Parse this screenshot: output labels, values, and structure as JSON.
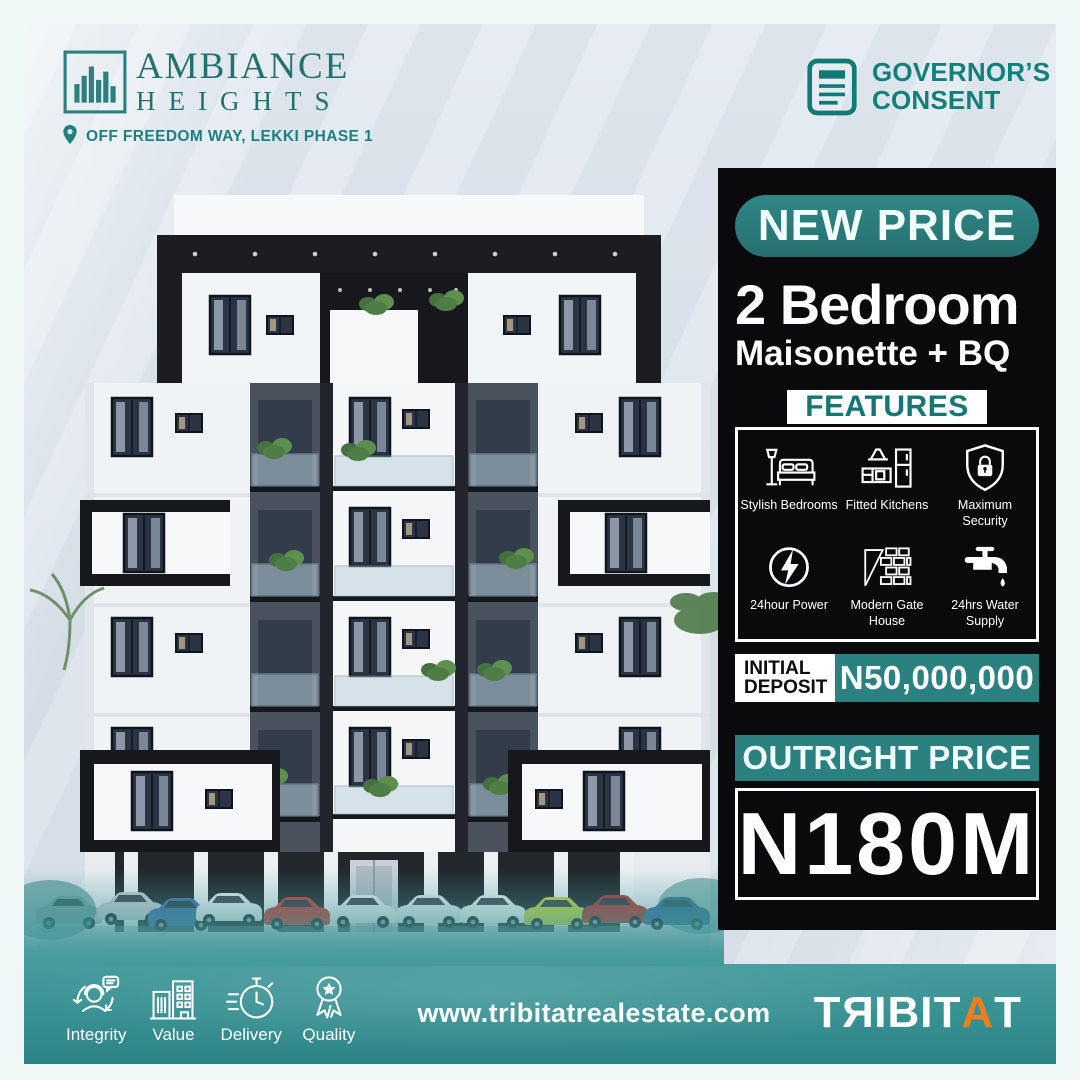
{
  "brand": {
    "name_line1": "AMBIANCE",
    "name_line2": "HEIGHTS",
    "location": "OFF FREEDOM WAY, LEKKI PHASE 1"
  },
  "badge": {
    "line1": "GOVERNOR’S",
    "line2": "CONSENT"
  },
  "offer": {
    "tag": "NEW PRICE",
    "unit_line1": "2 Bedroom",
    "unit_line2": "Maisonette + BQ",
    "features_title": "FEATURES",
    "features": [
      {
        "icon": "bed-icon",
        "label": "Stylish Bedrooms"
      },
      {
        "icon": "kitchen-icon",
        "label": "Fitted Kitchens"
      },
      {
        "icon": "shield-lock-icon",
        "label": "Maximum Security"
      },
      {
        "icon": "lightning-icon",
        "label": "24hour Power"
      },
      {
        "icon": "gatehouse-icon",
        "label": "Modern Gate House"
      },
      {
        "icon": "water-tap-icon",
        "label": "24hrs Water Supply"
      }
    ],
    "initial_deposit": {
      "line1": "INITIAL",
      "line2": "DEPOSIT",
      "value": "N50,000,000"
    },
    "outright": {
      "label": "OUTRIGHT PRICE",
      "value": "N180M"
    }
  },
  "footer": {
    "values": [
      {
        "icon": "support-icon",
        "label": "Integrity"
      },
      {
        "icon": "buildings-icon",
        "label": "Value"
      },
      {
        "icon": "stopwatch-icon",
        "label": "Delivery"
      },
      {
        "icon": "medal-icon",
        "label": "Quality"
      }
    ],
    "website": "www.tribitatrealestate.com",
    "logo": {
      "t1": "T",
      "r": "R",
      "mid": "IBIT",
      "accent": "A",
      "t2": "T"
    }
  },
  "colors": {
    "teal": "#2A8180",
    "teal_dark": "#157672",
    "footer_teal": "#3B9496",
    "panel_bg": "#0A0A0C",
    "orange": "#EE7E1B",
    "background": "#DCE4EB",
    "border": "#EFF8F6"
  }
}
